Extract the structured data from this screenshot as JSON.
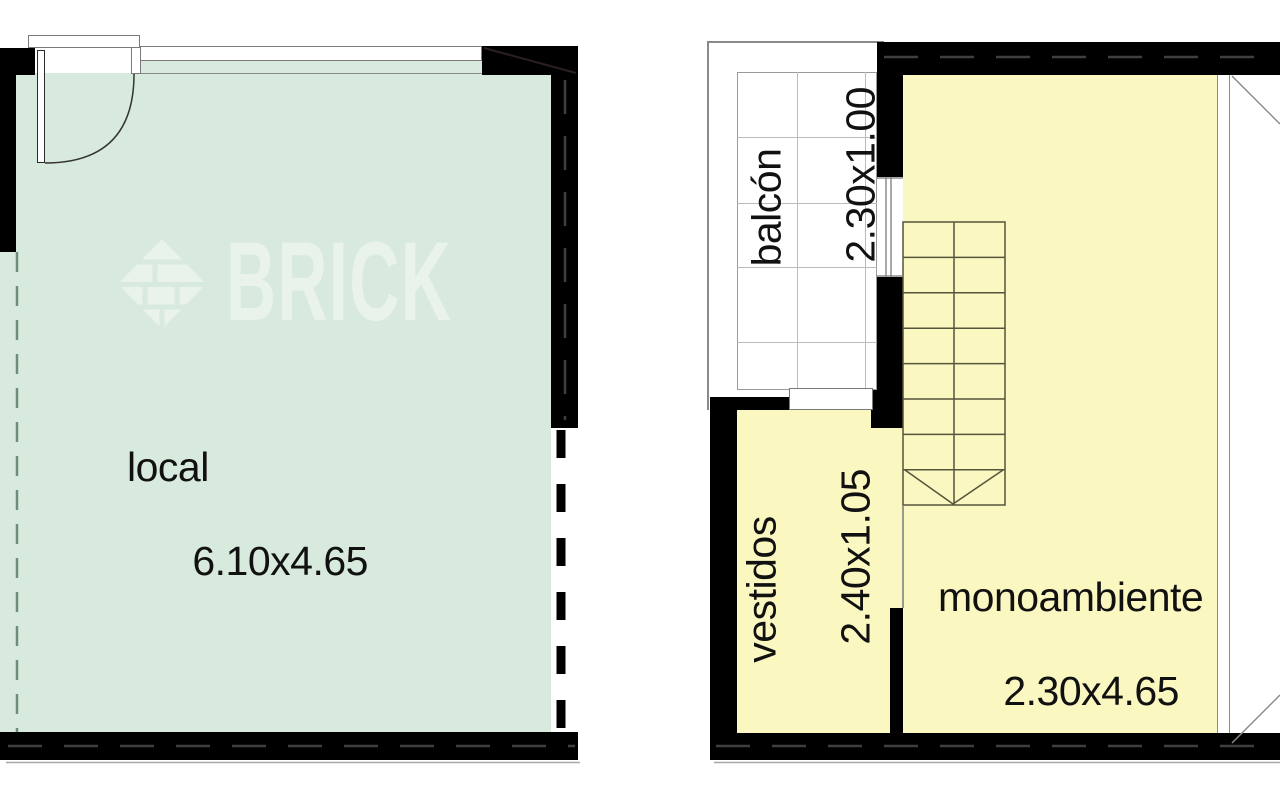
{
  "document": {
    "type": "floor-plan"
  },
  "watermark": {
    "brand": "BRICK",
    "logo": "brick-diamond-logo"
  },
  "plans": [
    {
      "id": "left-plan",
      "rooms": [
        {
          "name": "local",
          "dimensions": "6.10x4.65"
        }
      ],
      "features": [
        "entry-door-swing",
        "top-window",
        "dashed-property-lines"
      ]
    },
    {
      "id": "right-plan",
      "rooms": [
        {
          "name": "balcón",
          "dimensions": "2.30x1.00"
        },
        {
          "name": "vestidos",
          "dimensions": "2.40x1.05"
        },
        {
          "name": "monoambiente",
          "dimensions": "2.30x4.65"
        }
      ],
      "features": [
        "staircase",
        "balcony-door",
        "wall-window",
        "facade-glazing-diagonals"
      ]
    }
  ],
  "colors": {
    "room_green": "#d8eadd",
    "room_yellow": "#fbf7c0",
    "wall_black": "#000000",
    "watermark_color": "#e9f3ea",
    "line_gray": "#888888",
    "stair_line": "#55543c",
    "text_color": "#111111",
    "property_line_green": "#6d8d7c"
  }
}
